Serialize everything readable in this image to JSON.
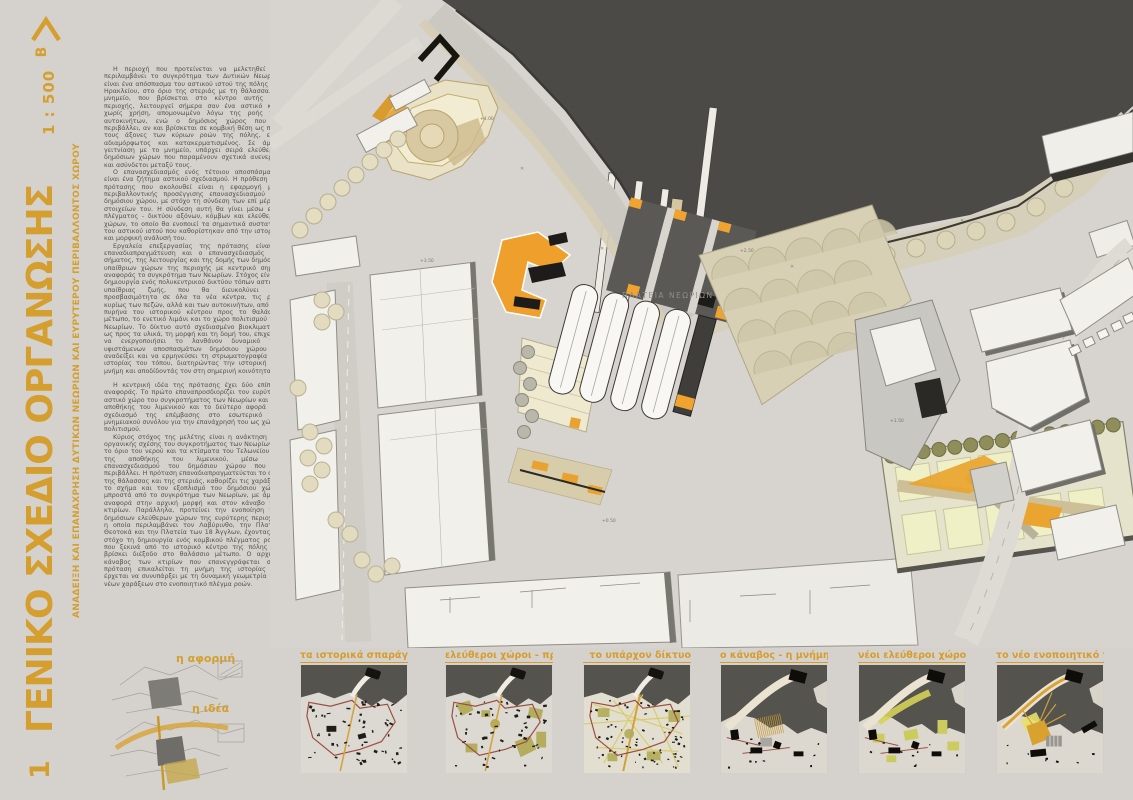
{
  "panel": {
    "number": "54022",
    "index": "1",
    "scale": "1 : 500",
    "north_label": "B"
  },
  "title": {
    "main": "ΓΕΝΙΚΟ ΣΧΕΔΙΟ ΟΡΓΑΝΩΣΗΣ",
    "subtitle": "ΑΝΑΔΕΙΞΗ ΚΑΙ ΕΠΑΝΑΧΡΗΣΗ ΔΥΤΙΚΩΝ ΝΕΩΡΙΩΝ ΚΑΙ ΕΥΡΥΤΕΡΟΥ ΠΕΡΙΒΑΛΛΟΝΤΟΣ ΧΩΡΟΥ"
  },
  "body_text": {
    "paragraphs": [
      "Η περιοχή που προτείνεται να μελετηθεί και περιλαμβάνει το συγκρότημα των Δυτικών Νεωρίων είναι ένα απόσπασμα του αστικού ιστού της πόλης του Ηρακλείου, στο όριο της στεριάς με τη θάλασσα. Το μνημείο, που βρίσκεται στο κέντρο αυτής της περιοχής, λειτουργεί σήμερα σαν ένα αστικό κενό χωρίς χρήση, απομονωμένο λόγω της ροής των αυτοκινήτων, ενώ ο δημόσιος χώρος που το περιβάλλει, αν και βρίσκεται σε κομβική θέση ως προς τους άξονες των κύριων ροών της πόλης, είναι αδιαμόρφωτος και κατακερματισμένος. Σε άμεση γειτνίαση με το μνημείο, υπάρχει σειρά ελεύθερων δημόσιων χώρων που παραμένουν σχετικά ανενεργοί και ασύνδετοι μεταξύ τους.",
      "Ο επανασχεδιασμός ενός τέτοιου αποσπάσματος είναι ένα ζήτημα αστικού σχεδιασμού. Η πρόθεση της πρότασης που ακολουθεί είναι η εφαρμογή μίας περιβαλλοντικής προσέγγισης επανασχεδιασμού του δημόσιου χώρου, με στόχο τη σύνδεση των επί μέρους στοιχείων του. Η σύνδεση αυτή θα γίνει μέσω ενός πλέγματος - δικτύου αξόνων, κόμβων και ελεύθερων χώρων, το οποίο θα ενοποιεί τα σημαντικά συστατικά του αστικού ιστού που καθορίστηκαν από την ιστορική και μορφική ανάλυσή του.",
      "Εργαλεία επεξεργασίας της πρότασης είναι η επαναδιαπραγμάτευση και ο επανασχεδιασμός του σήματος, της λειτουργίας και της δομής των δημόσιων υπαίθριων χώρων της περιοχής με κεντρικό σημείο αναφοράς το συγκρότημα των Νεωρίων. Στόχος είναι η δημιουργία ενός πολυκεντρικού δικτύου τόπων αστικής υπαίθριας ζωής, που θα διευκολύνει την προσβασιμότητα σε όλα τα νέα κέντρα, τις ροές κυρίως των πεζών, αλλά και των αυτοκινήτων, από τον πυρήνα του ιστορικού κέντρου προς το θαλάσσιο μέτωπο, το ενετικό λιμάνι και το χώρο πολιτισμού των Νεωρίων. Το δίκτυο αυτό σχεδιασμένο βιοκλιματικά, ως προς τα υλικά, τη μορφή και τη δομή του, επιχειρεί να ενεργοποιήσει το λανθάνον δυναμικό των υφιστάμενων αποσπασμάτων δημόσιου χώρου να αναδείξει και να ερμηνεύσει τη στρωματογραφία της ιστορίας του τόπου, διατηρώντας την ιστορική του μνήμη και αποδίδοντάς τον στη σημερινή κοινότητα.",
      "Η κεντρική ιδέα της πρότασης έχει δύο επίπεδα αναφοράς. Το πρώτο επαναπροσδιορίζει τον ευρύτερο αστικό χώρο του συγκροτήματος των Νεωρίων και της αποθήκης του λιμενικού και το δεύτερο αφορά στο σχεδιασμό της επέμβασης στο εσωτερικό του μνημειακού συνόλου για την επανάχρησή του ως χώρου πολιτισμού.",
      "Κύριος στόχος της μελέτης είναι η ανάκτηση της οργανικής σχέσης του συγκροτήματος των Νεωρίων με το όριο του νερού και τα κτίσματα του Τελωνείου και της αποθήκης του λιμενικού, μέσω του επανασχεδιασμού του δημόσιου χώρου που τα περιβάλλει. Η πρόταση επαναδιαπραγματεύεται το όριο της θάλασσας και της στεριάς, καθορίζει τις χαράξεις, το σχήμα και τον εξοπλισμό του δημόσιου χώρου μπροστά από το συγκρότημα των Νεωρίων, με άμεση αναφορά στην αρχική μορφή και στον κάναβο των κτιρίων. Παράλληλα, προτείνει την ενοποίηση των δημόσιων ελεύθερων χώρων της ευρύτερης περιοχής, η οποία περιλαμβάνει τον Λαβύρινθο, την Πλατεία Θεοτοκά και την Πλατεία των 18 Άγγλων, έχοντας ως στόχο τη δημιουργία ενός κομβικού πλέγματος ροών, που ξεκινά από το ιστορικό κέντρο της πόλης και βρίσκει διέξοδο στο θαλάσσιο μέτωπο. Ο αρχικός κάναβος των κτιρίων που επανεγγράφεται στην πρόταση επικαλείται τη μνήμη της ιστορίας και έρχεται να συνυπάρξει με τη δυναμική γεωμετρία των νέων χαράξεων στο ενοποιητικό πλέγμα ροών."
    ]
  },
  "plan": {
    "square_label": "ΠΛΑΤΕΙΑ ΝΕΩΡΙΩΝ",
    "spot_elevations": [
      "+4.00",
      "+3.50",
      "+2.50",
      "+1.50",
      "+0.50"
    ]
  },
  "sketches": [
    {
      "label": "η αφορμή"
    },
    {
      "label": "η ιδέα"
    }
  ],
  "thumbnails": [
    {
      "label": "τα ιστορικά σπαράγματα"
    },
    {
      "label": "ελεύθεροι χώροι - πράσινο"
    },
    {
      "label": "το υπάρχον δίκτυο"
    },
    {
      "label": "ο κάναβος - η μνήμη"
    },
    {
      "label": "νέοι ελεύθεροι χώροι-πράσινο"
    },
    {
      "label": "το νέο ενοποιητικό πλέγμα"
    }
  ],
  "colors": {
    "accent_gold": "#d49f2e",
    "plan_orange": "#ef9f2c",
    "sea": "#4b4a46",
    "background": "#d5d2ce",
    "wall_red": "#9a4f40",
    "olive_green": "#b1ab57"
  }
}
